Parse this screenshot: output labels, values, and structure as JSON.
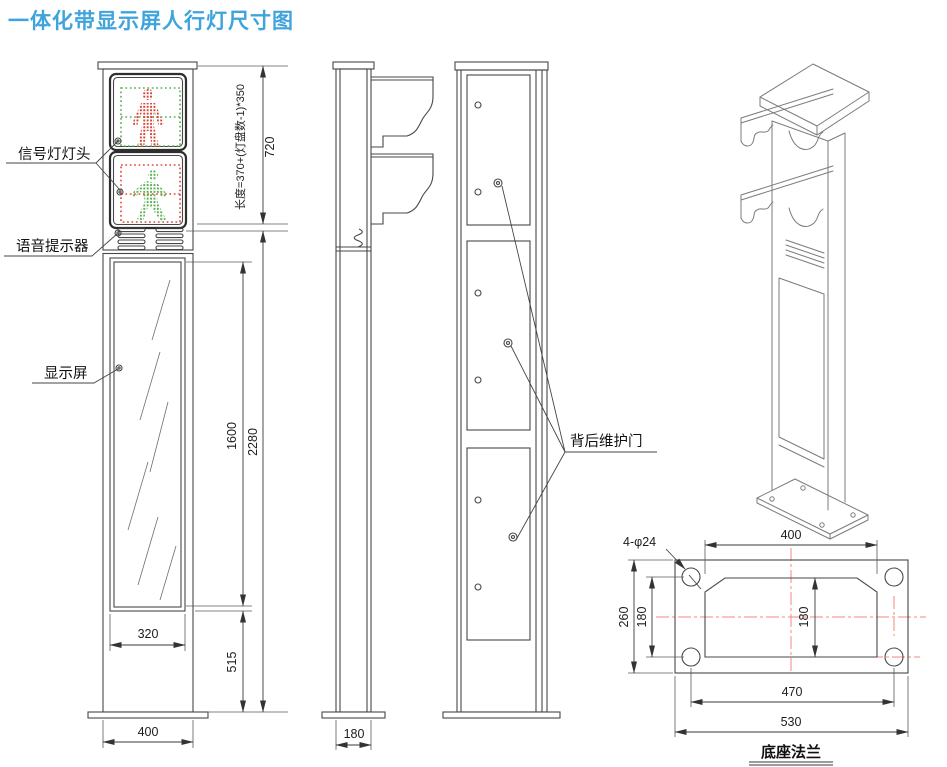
{
  "title": "一体化带显示屏人行灯尺寸图",
  "colors": {
    "title": "#3fa3dc",
    "line": "#474747",
    "iso_line": "#7b7b7b",
    "signal_red": "#d8402f",
    "signal_green": "#55b04b",
    "centerline_red": "#ef8b7d"
  },
  "front_view": {
    "labels": {
      "signal_head": "信号灯灯头",
      "voice": "语音提示器",
      "display": "显示屏"
    },
    "dims": {
      "length_formula": "长度=370+(灯盘数-1)*350",
      "head_height": "720",
      "total_height": "2280",
      "screen_height": "1600",
      "screen_width": "320",
      "lower_height": "515",
      "base_width": "400"
    }
  },
  "side_view": {
    "dims": {
      "base_depth": "180"
    }
  },
  "back_view": {
    "labels": {
      "rear_door": "背后维护门"
    }
  },
  "flange_view": {
    "caption": "底座法兰",
    "dims": {
      "bolt_holes": "4-φ24",
      "inner_width": "400",
      "flange_height": "260",
      "hole_spacing_v": "180",
      "inner_height": "180",
      "hole_spacing_h": "470",
      "flange_width": "530"
    }
  }
}
